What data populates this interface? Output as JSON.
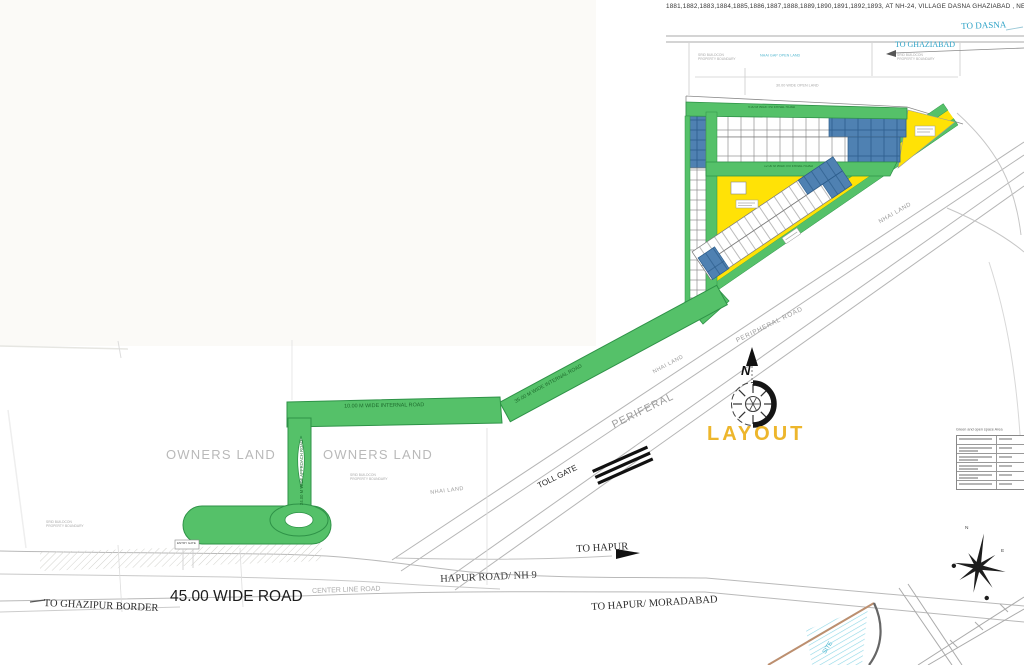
{
  "drawing_title": "1881,1882,1883,1884,1885,1886,1887,1888,1889,1890,1891,1892,1893, AT NH-24, VILLAGE DASNA GHAZIABAD , NEAR DASNA T",
  "destinations": {
    "to_dasna": "TO DASNA",
    "to_ghaziabad": "TO GHAZIABAD",
    "to_hapur": "TO HAPUR",
    "to_hapur_moradabad": "TO HAPUR/ MORADABAD",
    "to_ghazipur_border": "TO GHAZIPUR BORDER"
  },
  "roads": {
    "wide_45": "45.00 WIDE ROAD",
    "center_line": "CENTER LINE ROAD",
    "hapur_nh9": "HAPUR ROAD/ NH 9",
    "internal_10": "10.00 M WIDE INTERNAL ROAD",
    "internal_35": "35.00 M WIDE INTERNAL ROAD",
    "internal_9": "9.00 M WIDE INTERNAL ROAD",
    "internal_12": "12.00 M WIDE INTERNAL ROAD",
    "approach_24": "24.00 M WIDE APPROACH ROAD",
    "peripheral_road": "PERIPHERAL ROAD",
    "periferal": "PERIFERAL",
    "toll_gate": "TOLL GATE",
    "entry_gate": "ENTRY GATE"
  },
  "areas": {
    "owners_land": "OWNERS LAND",
    "nhai_land": "NHAI LAND",
    "nhai_gap_open_land": "NHAI GAP OPEN LAND",
    "open_land_30": "30.00 WIDE OPEN LAND",
    "site": "SITE"
  },
  "boundary_note": {
    "line1": "SRID BUILDCON",
    "line2": "PROPERTY BOUNDARY"
  },
  "compass": {
    "north": "N",
    "east": "E"
  },
  "stamp": "LAYOUT",
  "legend": {
    "title": "Green and open space Area"
  },
  "colors": {
    "road_green": "#55c169",
    "plot_yellow": "#ffe206",
    "plot_blue": "#4f81b2",
    "stamp_yellow": "#edb62c",
    "cyan_label": "#2fa3c7"
  }
}
